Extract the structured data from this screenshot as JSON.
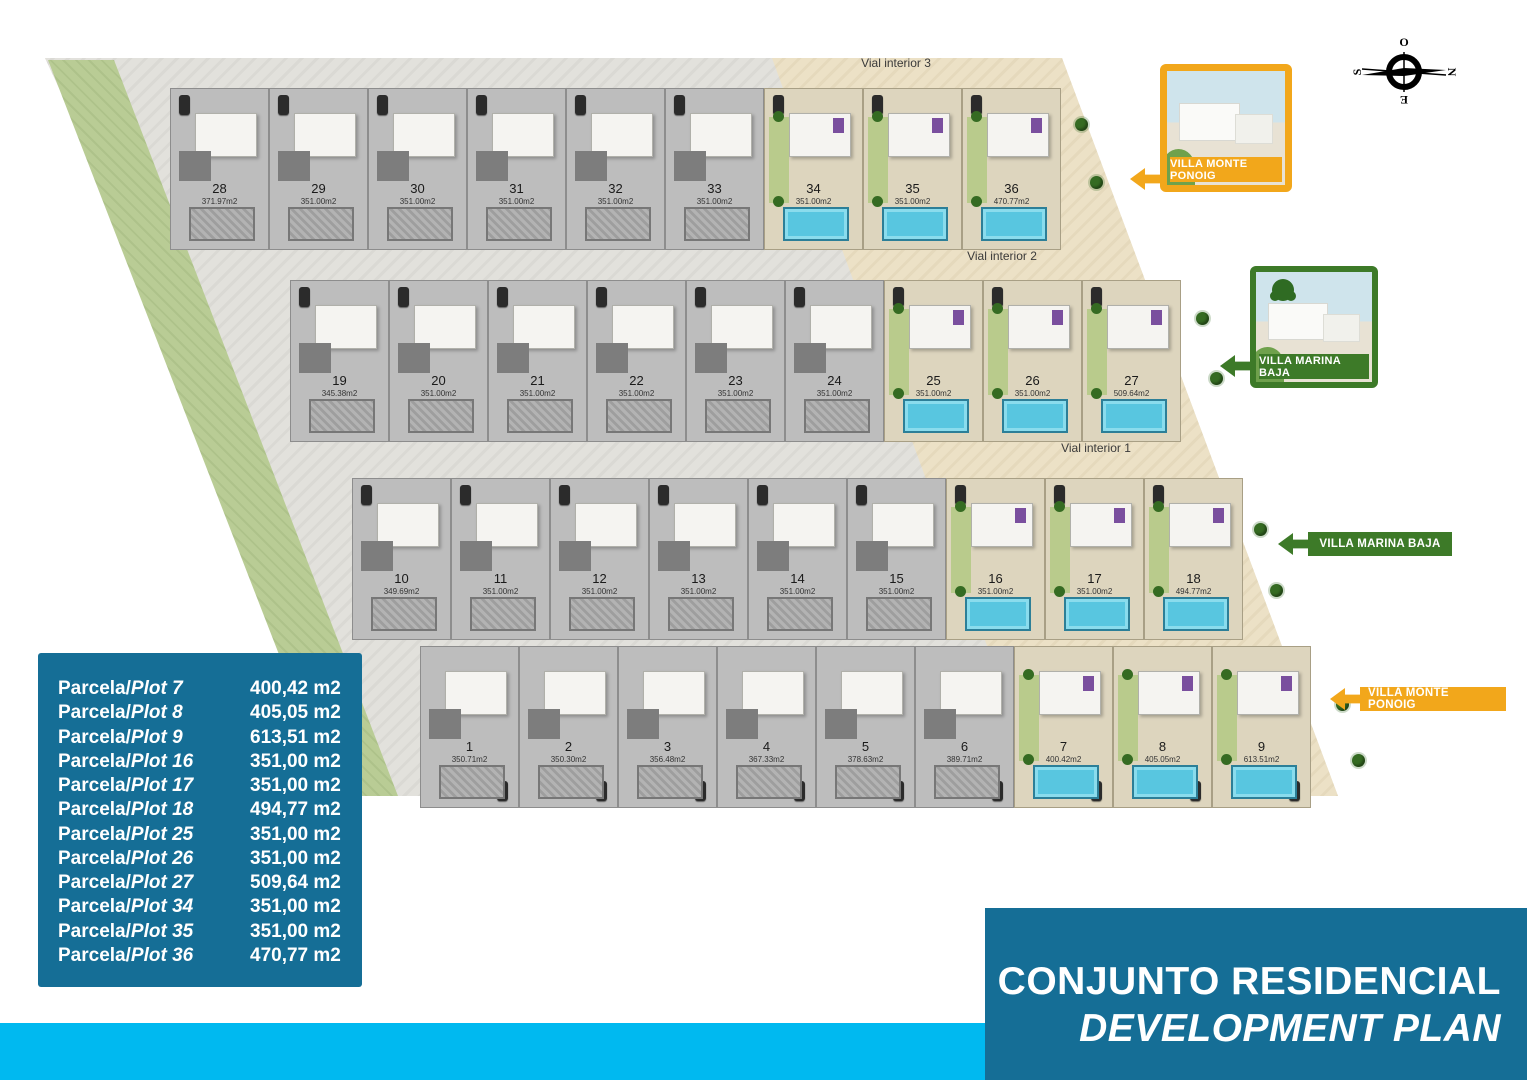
{
  "colors": {
    "brand_teal": "#156e96",
    "cyan_strip": "#00b9f0",
    "orange_accent": "#F2A71B",
    "green_accent": "#3D7A28",
    "pool_blue": "#58c6e0",
    "lawn_green": "#b9cc95"
  },
  "compass": {
    "top": "O",
    "right": "N",
    "bottom": "E",
    "left": "S"
  },
  "cards": [
    {
      "label": "VILLA MONTE PONOIG"
    },
    {
      "label": "VILLA MARINA BAJA"
    }
  ],
  "banners": [
    {
      "label": "VILLA MARINA BAJA"
    },
    {
      "label": "VILLA MONTE PONOIG"
    }
  ],
  "plan": {
    "roads": [
      "Vial interior 3",
      "Vial interior 2",
      "Vial interior 1"
    ],
    "row_a": [
      {
        "num": "28",
        "area": "371.97m2",
        "state": "gray"
      },
      {
        "num": "29",
        "area": "351.00m2",
        "state": "gray"
      },
      {
        "num": "30",
        "area": "351.00m2",
        "state": "gray"
      },
      {
        "num": "31",
        "area": "351.00m2",
        "state": "gray"
      },
      {
        "num": "32",
        "area": "351.00m2",
        "state": "gray"
      },
      {
        "num": "33",
        "area": "351.00m2",
        "state": "gray"
      },
      {
        "num": "34",
        "area": "351.00m2",
        "state": "color"
      },
      {
        "num": "35",
        "area": "351.00m2",
        "state": "color"
      },
      {
        "num": "36",
        "area": "470.77m2",
        "state": "color"
      }
    ],
    "row_b": [
      {
        "num": "19",
        "area": "345.38m2",
        "state": "gray"
      },
      {
        "num": "20",
        "area": "351.00m2",
        "state": "gray"
      },
      {
        "num": "21",
        "area": "351.00m2",
        "state": "gray"
      },
      {
        "num": "22",
        "area": "351.00m2",
        "state": "gray"
      },
      {
        "num": "23",
        "area": "351.00m2",
        "state": "gray"
      },
      {
        "num": "24",
        "area": "351.00m2",
        "state": "gray"
      },
      {
        "num": "25",
        "area": "351.00m2",
        "state": "color"
      },
      {
        "num": "26",
        "area": "351.00m2",
        "state": "color"
      },
      {
        "num": "27",
        "area": "509.64m2",
        "state": "color"
      }
    ],
    "row_c": [
      {
        "num": "10",
        "area": "349.69m2",
        "state": "gray"
      },
      {
        "num": "11",
        "area": "351.00m2",
        "state": "gray"
      },
      {
        "num": "12",
        "area": "351.00m2",
        "state": "gray"
      },
      {
        "num": "13",
        "area": "351.00m2",
        "state": "gray"
      },
      {
        "num": "14",
        "area": "351.00m2",
        "state": "gray"
      },
      {
        "num": "15",
        "area": "351.00m2",
        "state": "gray"
      },
      {
        "num": "16",
        "area": "351.00m2",
        "state": "color"
      },
      {
        "num": "17",
        "area": "351.00m2",
        "state": "color"
      },
      {
        "num": "18",
        "area": "494.77m2",
        "state": "color"
      }
    ],
    "row_d": [
      {
        "num": "1",
        "area": "350.71m2",
        "state": "gray"
      },
      {
        "num": "2",
        "area": "350.30m2",
        "state": "gray"
      },
      {
        "num": "3",
        "area": "356.48m2",
        "state": "gray"
      },
      {
        "num": "4",
        "area": "367.33m2",
        "state": "gray"
      },
      {
        "num": "5",
        "area": "378.63m2",
        "state": "gray"
      },
      {
        "num": "6",
        "area": "389.71m2",
        "state": "gray"
      },
      {
        "num": "7",
        "area": "400.42m2",
        "state": "color"
      },
      {
        "num": "8",
        "area": "405.05m2",
        "state": "color"
      },
      {
        "num": "9",
        "area": "613.51m2",
        "state": "color"
      }
    ]
  },
  "legend": [
    {
      "prefix": "Parcela/",
      "plot": "Plot 7",
      "area": "400,42 m2"
    },
    {
      "prefix": "Parcela/",
      "plot": "Plot 8",
      "area": "405,05 m2"
    },
    {
      "prefix": "Parcela/",
      "plot": "Plot 9",
      "area": "613,51 m2"
    },
    {
      "prefix": "Parcela/",
      "plot": "Plot 16",
      "area": "351,00 m2"
    },
    {
      "prefix": "Parcela/",
      "plot": "Plot 17",
      "area": "351,00 m2"
    },
    {
      "prefix": "Parcela/",
      "plot": "Plot 18",
      "area": "494,77 m2"
    },
    {
      "prefix": "Parcela/",
      "plot": "Plot 25",
      "area": "351,00 m2"
    },
    {
      "prefix": "Parcela/",
      "plot": "Plot 26",
      "area": "351,00 m2"
    },
    {
      "prefix": "Parcela/",
      "plot": "Plot 27",
      "area": "509,64 m2"
    },
    {
      "prefix": "Parcela/",
      "plot": "Plot 34",
      "area": "351,00 m2"
    },
    {
      "prefix": "Parcela/",
      "plot": "Plot 35",
      "area": "351,00 m2"
    },
    {
      "prefix": "Parcela/",
      "plot": "Plot 36",
      "area": "470,77 m2"
    }
  ],
  "title": {
    "line1": "CONJUNTO RESIDENCIAL",
    "line2": "DEVELOPMENT PLAN"
  }
}
